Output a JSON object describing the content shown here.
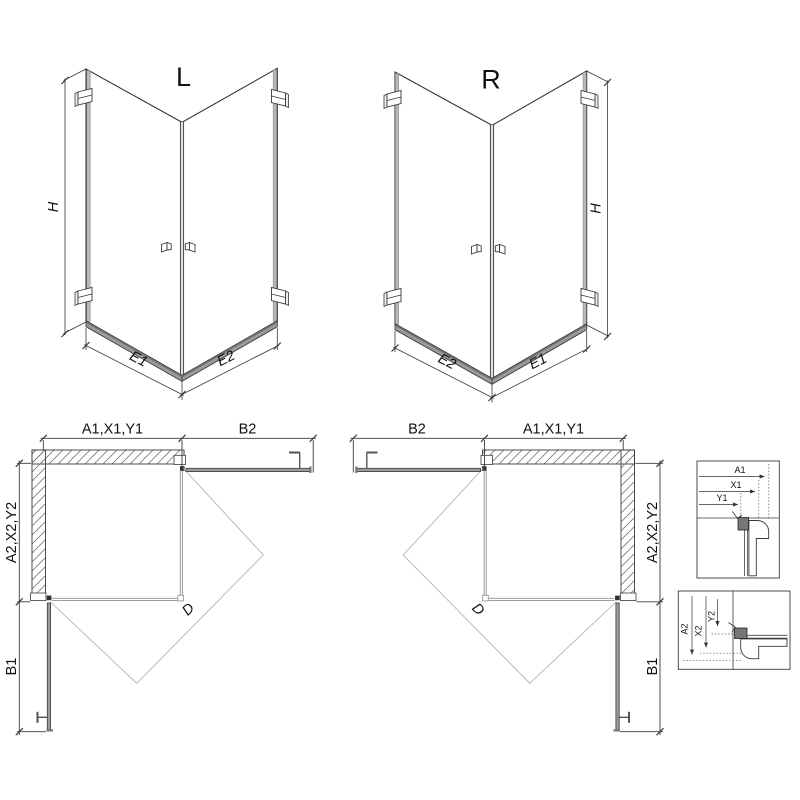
{
  "drawing": {
    "iso_left": {
      "label": "L",
      "height_dim": "H",
      "bottom_left_dim": "E1",
      "bottom_right_dim": "E2"
    },
    "iso_right": {
      "label": "R",
      "height_dim": "H",
      "bottom_left_dim": "E2",
      "bottom_right_dim": "E1"
    },
    "plan_left": {
      "top_dim": "A1,X1,Y1",
      "top_right_dim": "B2",
      "side_upper_dim": "A2,X2,Y2",
      "side_lower_dim": "B1",
      "diagonal_dim": "D"
    },
    "plan_right": {
      "top_left_dim": "B2",
      "top_dim": "A1,X1,Y1",
      "side_upper_dim": "A2,X2,Y2",
      "side_lower_dim": "B1",
      "diagonal_dim": "D"
    },
    "detail_top": {
      "dims": [
        "A1",
        "X1",
        "Y1"
      ]
    },
    "detail_bottom": {
      "dims": [
        "A2",
        "X2",
        "Y2"
      ]
    }
  },
  "colors": {
    "line": "#3a3a3a",
    "glass_line": "#8f8f8f",
    "swing_line": "#ababab",
    "profile_gray": "#b8b8b8",
    "rail_gray": "#9b9b9b",
    "hardware": "#555555",
    "hatch": "#7a7a7a",
    "text": "#111111"
  }
}
